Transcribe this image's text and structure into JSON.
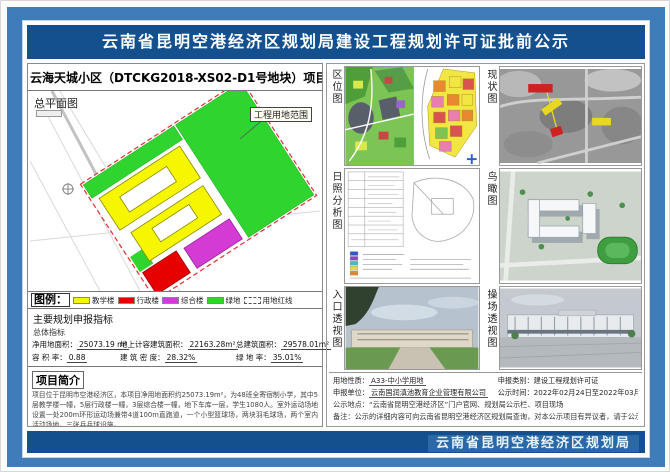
{
  "header": {
    "title": "云南省昆明空港经济区规划局建设工程规划许可证批前公示"
  },
  "footer": {
    "agency": "云南省昆明空港经济区规划局"
  },
  "project": {
    "title": "云海天城小区（DTCKG2018-XS02-D1号地块）项目",
    "site_plan_label": "总平面图",
    "boundary_label": "工程用地范围"
  },
  "legend": {
    "title": "图例：",
    "items": [
      {
        "name": "教学楼",
        "color": "#f6f600"
      },
      {
        "name": "行政楼",
        "color": "#e60000"
      },
      {
        "name": "综合楼",
        "color": "#d43bd4"
      },
      {
        "name": "绿地",
        "color": "#2fd42f"
      },
      {
        "name": "用地红线",
        "color": "dashed-red"
      }
    ]
  },
  "indicators": {
    "title": "主要规划申报指标",
    "subtitle": "总体指标",
    "items": [
      {
        "label": "净用地面积：",
        "value": "25073.19 m²"
      },
      {
        "label": "地上计容建筑面积：",
        "value": "22163.28m²"
      },
      {
        "label": "总建筑面积：",
        "value": "29578.01m²"
      },
      {
        "label": "容 积 率：",
        "value": "0.88"
      },
      {
        "label": "建 筑 密 度：",
        "value": "28.32%"
      },
      {
        "label": "绿 地 率：",
        "value": "35.01%"
      }
    ]
  },
  "intro": {
    "title": "项目简介",
    "paragraph1": "项目位于昆明市空港经济区，本项目净用地面积约25073.19m²，为48班全寄宿制小学，其中5层教学楼一幢，5层行政楼一幢，3层综合楼一幢，地下车库一层，学生1080人。室外运动场地设置一处200m环形运动场兼带4道100m直跑道，一个小型篮球场，两块羽毛球场，两个室内活动场地，三张乒乓球设施。",
    "paragraph2": "项目用地为A33-中小学用地，总计容建筑面积 22163.28m²，容积率0.88，地下建筑面积为2340.98m²"
  },
  "gallery": {
    "location_label": "区位图",
    "status_label": "现状图",
    "sunshine_label": "日照分析图",
    "birdseye_label": "鸟瞰图",
    "entrance_label": "入口透视图",
    "playground_label": "操场透视图"
  },
  "notice": {
    "land_use_label": "用地性质：",
    "land_use": "A33-中小学用地",
    "category_label": "申报类别：",
    "category": "建设工程规划许可证",
    "applicant_label": "申报单位：",
    "applicant": "云南国润滇池教育企业管理有限公司",
    "period_label": "公示时间：",
    "period": "2022年02月24日至2022年03月04日",
    "venue": "公示地点：“云南省昆明空港经济区”门户官网、规划局公示栏、项目现场",
    "note": "备注：公示的详细内容可向云南省昆明空港经济区规划局查询，对本公示项目有异议者，请于公示期内致电：67288855。"
  }
}
